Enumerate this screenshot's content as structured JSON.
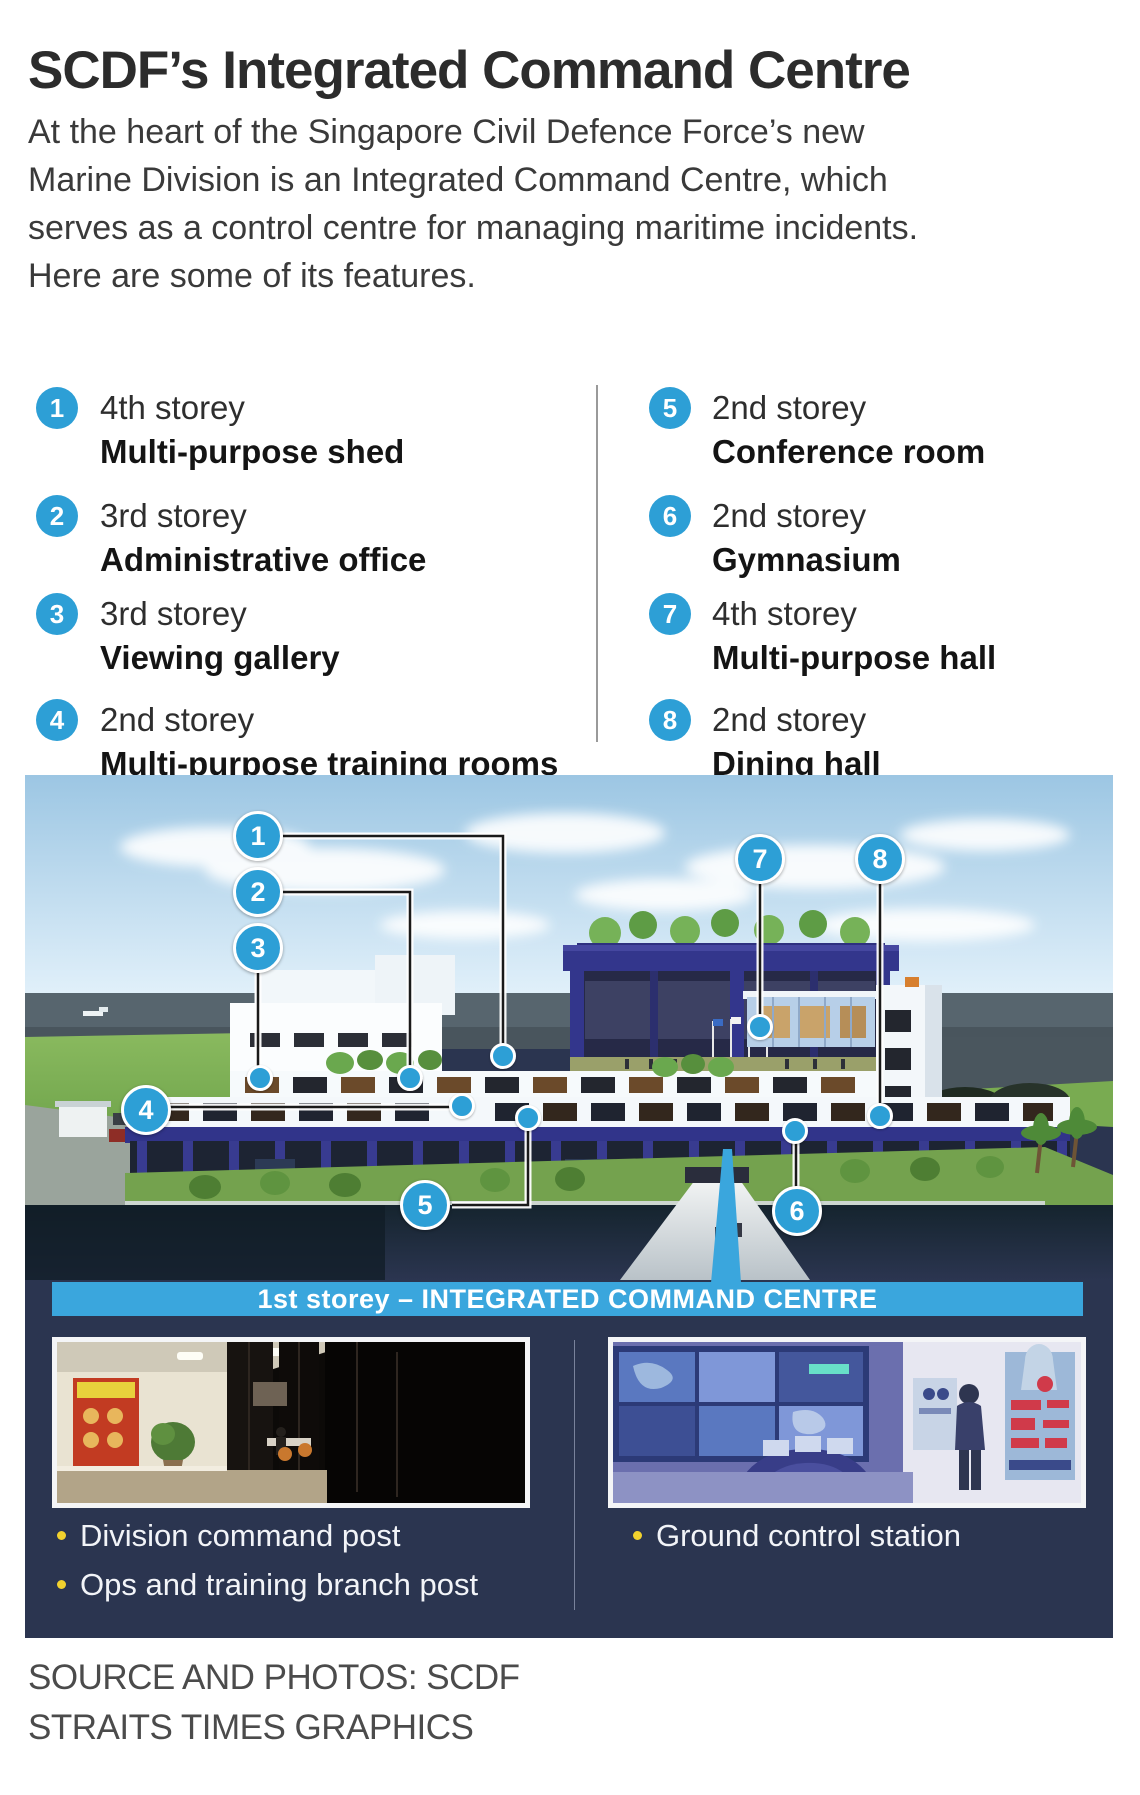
{
  "header": {
    "title": "SCDF’s Integrated Command Centre",
    "intro_lines": [
      "At the heart of the Singapore Civil Defence Force’s new",
      "Marine Division is an Integrated Command Centre, which",
      "serves as a control centre for managing maritime incidents.",
      "Here are some of its features."
    ]
  },
  "features": {
    "left": [
      {
        "num": "1",
        "storey": "4th storey",
        "name": "Multi-purpose shed"
      },
      {
        "num": "2",
        "storey": "3rd storey",
        "name": "Administrative office"
      },
      {
        "num": "3",
        "storey": "3rd storey",
        "name": "Viewing gallery"
      },
      {
        "num": "4",
        "storey": "2nd storey",
        "name": "Multi-purpose training rooms"
      }
    ],
    "right": [
      {
        "num": "5",
        "storey": "2nd storey",
        "name": "Conference room"
      },
      {
        "num": "6",
        "storey": "2nd storey",
        "name": "Gymnasium"
      },
      {
        "num": "7",
        "storey": "4th storey",
        "name": "Multi-purpose hall"
      },
      {
        "num": "8",
        "storey": "2nd storey",
        "name": "Dining hall"
      }
    ]
  },
  "diagram": {
    "banner": "1st storey – INTEGRATED COMMAND CENTRE"
  },
  "insets": {
    "left_captions": [
      "Division command post",
      "Ops and training branch post"
    ],
    "right_captions": [
      "Ground control station"
    ]
  },
  "footer": {
    "line1": "SOURCE AND PHOTOS: SCDF",
    "line2": "STRAITS TIMES GRAPHICS"
  },
  "colors": {
    "accent_blue": "#2d9fd6",
    "banner_blue": "#3aa6dd",
    "panel_navy": "#2b3550",
    "bullet_yellow": "#f2d22e"
  }
}
